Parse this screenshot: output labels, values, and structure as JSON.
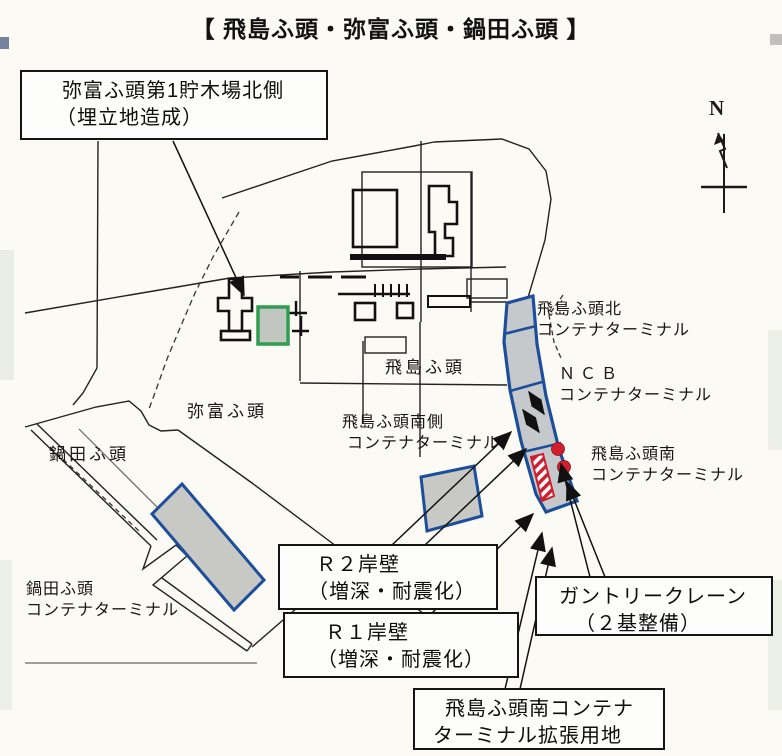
{
  "title": "【 飛島ふ頭・弥富ふ頭・鍋田ふ頭 】",
  "compass": {
    "label": "N"
  },
  "callouts": {
    "yatomi_lumber": {
      "line1": "弥富ふ頭第1貯木場北側",
      "line2": "（埋立地造成）"
    },
    "r2_quay": {
      "line1": "Ｒ２岸壁",
      "line2": "（増深・耐震化）"
    },
    "r1_quay": {
      "line1": "Ｒ１岸壁",
      "line2": "（増深・耐震化）"
    },
    "gantry_crane": {
      "line1": "ガントリークレーン",
      "line2": "（２基整備）"
    },
    "expansion": {
      "line1": "飛島ふ頭南コンテナ",
      "line2": "ターミナル拡張用地"
    }
  },
  "map_labels": {
    "tobishima_pier": "飛島ふ頭",
    "yatomi_pier": "弥富ふ頭",
    "nabeta_pier": "鍋田ふ頭",
    "tobishima_north_ct": {
      "line1": "飛島ふ頭北",
      "line2": "コンテナターミナル"
    },
    "ncb_ct": {
      "line1": "ＮＣＢ",
      "line2": "コンテナターミナル"
    },
    "tobishima_south_ct": {
      "line1": "飛島ふ頭南",
      "line2": "コンテナターミナル"
    },
    "tobishima_southside_ct": {
      "line1": "飛島ふ頭南側",
      "line2": "コンテナターミナル"
    },
    "nabeta_ct": {
      "line1": "鍋田ふ頭",
      "line2": "コンテナターミナル"
    }
  },
  "legend_colors": {
    "terminal_outline_blue": "#1d4e9b",
    "terminal_fill_gray": "#c8c8c4",
    "reclamation_green": "#2f9e50",
    "quay_red": "#cf1f2f",
    "line_black": "#1a1a1a"
  }
}
